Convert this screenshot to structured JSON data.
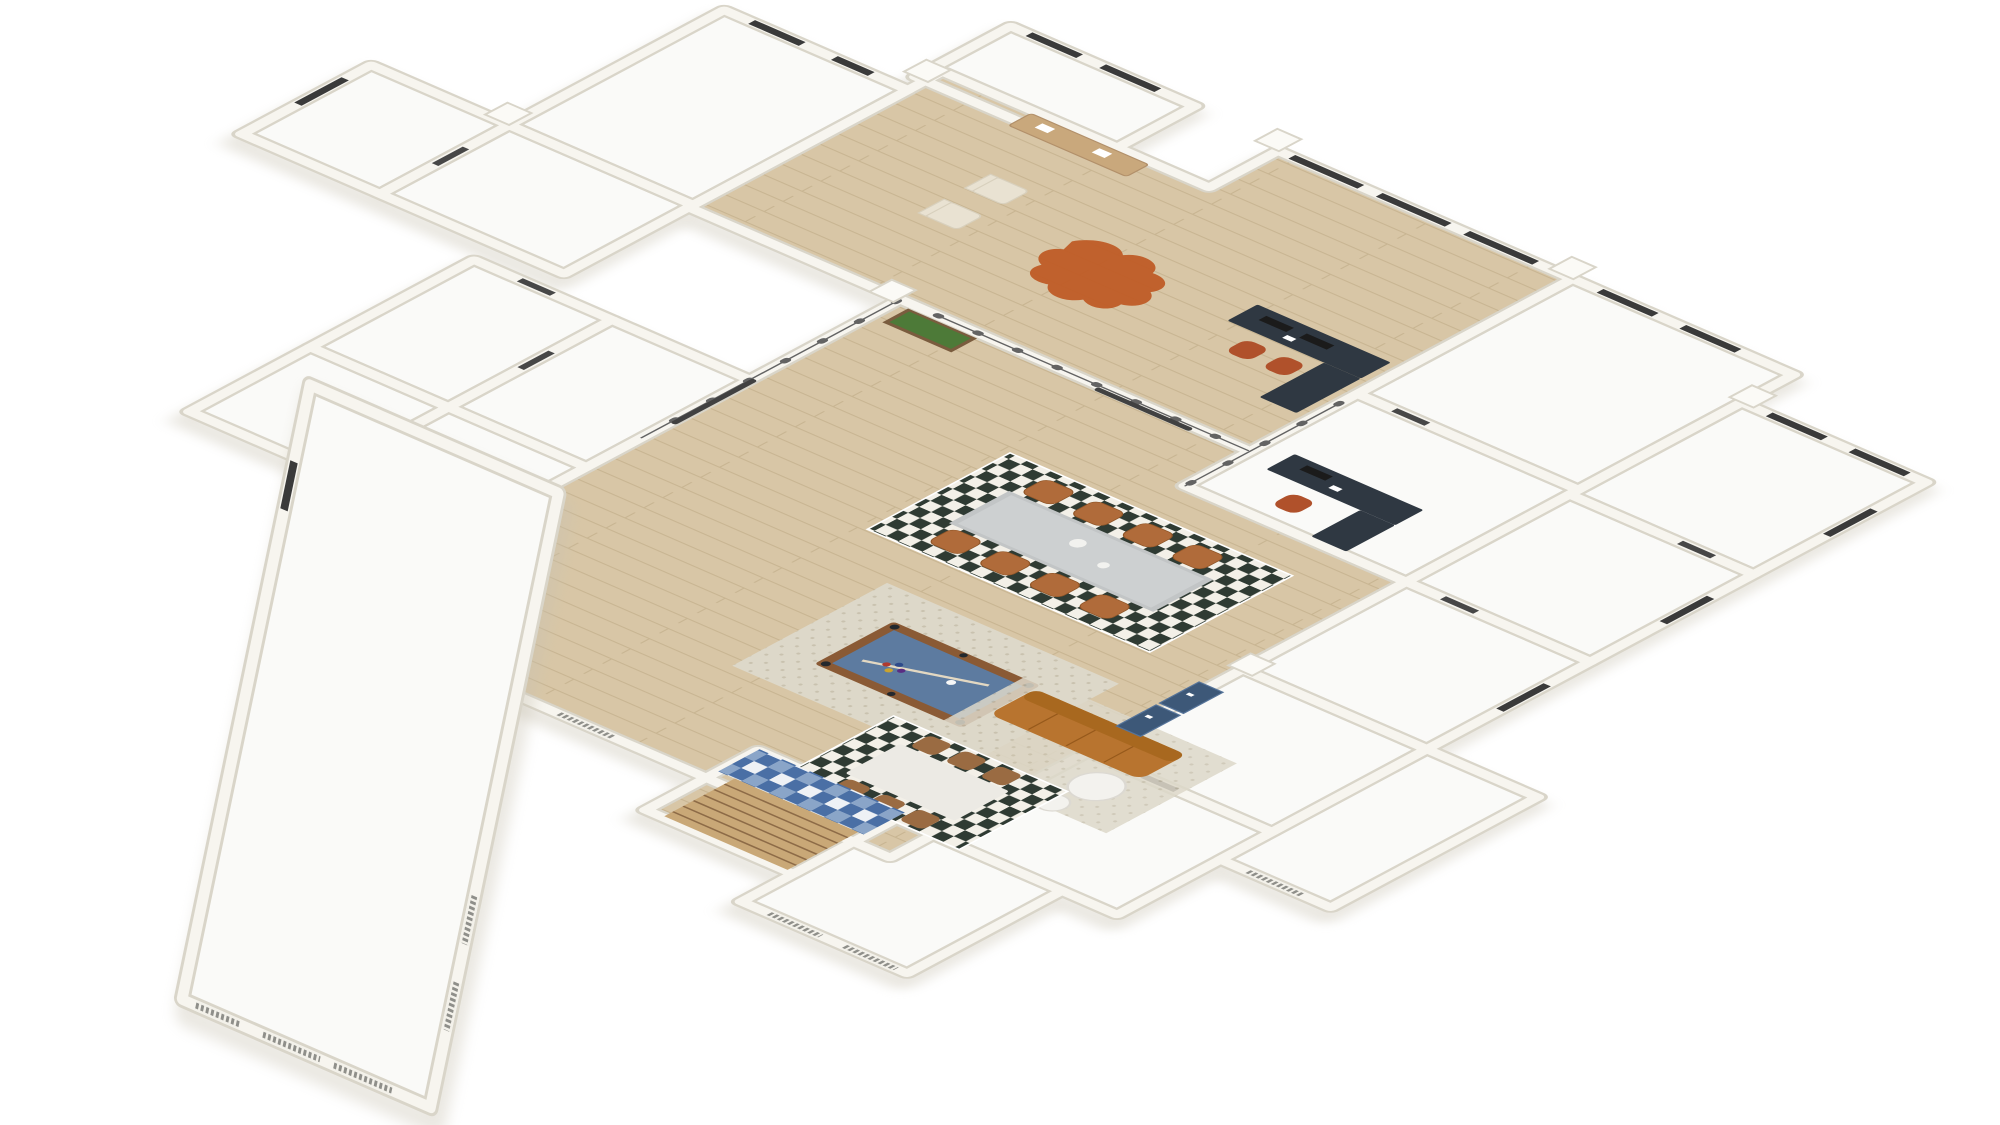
{
  "scene": {
    "type": "3d-floorplan-render",
    "projection": "isometric",
    "background": "#ffffff",
    "description": "Isometric 3D rendering of a large floor plan: central wood-floored open hall with billiard table, long dining table and lounge, office desks at top right, surrounded by empty white rooms and an angled lower-left wing with a large empty great room."
  },
  "colors": {
    "wall": "#f7f5ef",
    "wall_edge": "#d9d5c9",
    "building_shadow": "#c9c3b2",
    "floor_white": "#fafaf8",
    "wood": "#d8c6a6",
    "wood_line": "#c8b592",
    "window_dark": "#3a3a3a",
    "louver": "#8f8f8a",
    "louver_frame": "#f3f1ea",
    "glass": "#636363",
    "glass_door": "#414141",
    "door_dark": "#474747",
    "rug_checker_light": "#f3f0e8",
    "rug_checker_dark": "#2f3b33",
    "rug_beige": "#ddd8c9",
    "rug_dot": "#c9c2af",
    "pool_frame": "#8a5a35",
    "pool_felt": "#5d7ba0",
    "pool_pocket": "#23282e",
    "cue": "#e3d8c2",
    "table_concrete": "#c2c5c6",
    "table_concrete_top": "#cdd0d1",
    "bowl": "#f2f2ef",
    "chair_leather": "#b06b3a",
    "chair_leather_edge": "#8f5527",
    "marble": "#eceae4",
    "marble_edge": "#d8d5cd",
    "chair_wood": "#9a6b42",
    "sofa": "#b8742f",
    "sofa_back": "#a8681f",
    "sofa_seam": "#96591b",
    "side_table": "#f3f2ee",
    "side_table_edge": "#dcd9d2",
    "cowhide": "#bf5c26",
    "lounge_cream": "#e9e2d2",
    "lounge_cream_edge": "#d8d0bd",
    "console": "#c9a87c",
    "console_edge": "#b2906a",
    "planter_box": "#7a5c3e",
    "planter_green": "#4d7a38",
    "desk": "#2f3842",
    "monitor": "#1b1b1b",
    "paper": "#ffffff",
    "office_chair": "#b0512b",
    "door_navy": "#3d5878",
    "door_navy_edge": "#56749a",
    "mosaic_blue": "#4a6fa5",
    "mosaic_blue_light": "#8aa5c8",
    "mosaic_bg": "#eef1f5",
    "stair": "#c9a877",
    "stair_line": "#8d6b47",
    "chimney": "#fbfaf6",
    "chimney_edge": "#d9d5c9"
  },
  "rooms": [
    {
      "id": "top-left-room-1",
      "floor": "white",
      "furnished": false
    },
    {
      "id": "top-center-room",
      "floor": "white",
      "furnished": false
    },
    {
      "id": "top-left-room-2",
      "floor": "white",
      "furnished": false
    },
    {
      "id": "top-right-room",
      "floor": "white",
      "furnished": false
    },
    {
      "id": "lounge",
      "floor": "wood",
      "furnished": true
    },
    {
      "id": "office-area",
      "floor": "wood",
      "furnished": true
    },
    {
      "id": "office-room",
      "floor": "white",
      "furnished": true
    },
    {
      "id": "storage-room",
      "floor": "white",
      "furnished": false
    },
    {
      "id": "open-hall",
      "floor": "wood",
      "furnished": true
    },
    {
      "id": "right-wing-room-1",
      "floor": "white",
      "furnished": false
    },
    {
      "id": "right-wing-room-2",
      "floor": "white",
      "furnished": false
    },
    {
      "id": "right-wing-room-3",
      "floor": "white",
      "furnished": false
    },
    {
      "id": "bottom-right-room-1",
      "floor": "white",
      "furnished": false
    },
    {
      "id": "bottom-right-room-2",
      "floor": "white",
      "furnished": false
    },
    {
      "id": "annex-room",
      "floor": "white",
      "furnished": false
    },
    {
      "id": "bottom-room",
      "floor": "white",
      "furnished": false
    },
    {
      "id": "small-room-1",
      "floor": "white",
      "furnished": false
    },
    {
      "id": "small-room-2",
      "floor": "white",
      "furnished": false
    },
    {
      "id": "small-room-3",
      "floor": "white",
      "furnished": false
    },
    {
      "id": "small-room-4",
      "floor": "white",
      "furnished": false
    },
    {
      "id": "entry-stair-hall",
      "floor": "wood",
      "furnished": true
    },
    {
      "id": "great-room-wing",
      "floor": "white",
      "furnished": false
    }
  ],
  "furniture": [
    {
      "id": "pool-table",
      "label": "billiard table with blue felt, cue and balls on beige rug"
    },
    {
      "id": "dining-table",
      "label": "long concrete dining table with 8 caramel leather chairs on checkered rug"
    },
    {
      "id": "breakfast-table",
      "label": "white marble table with 6 wooden chairs on checkered rug"
    },
    {
      "id": "sofa",
      "label": "caramel leather sofa with two round white coffee tables"
    },
    {
      "id": "desk-a",
      "label": "dark L-shaped office desk with monitors and rust chairs"
    },
    {
      "id": "desk-b",
      "label": "dark L-shaped office desk with monitor and rust chair"
    },
    {
      "id": "cowhide-rug",
      "label": "rust cowhide rug"
    },
    {
      "id": "lounge-chairs",
      "label": "pair of cream lounge chairs"
    },
    {
      "id": "console-bench",
      "label": "wooden console bench under window"
    },
    {
      "id": "planter",
      "label": "planter box with green hedge"
    },
    {
      "id": "navy-double-door",
      "label": "navy blue double doors"
    },
    {
      "id": "mosaic-floor",
      "label": "blue and white mosaic tile floor"
    },
    {
      "id": "staircase",
      "label": "wooden staircase"
    }
  ]
}
